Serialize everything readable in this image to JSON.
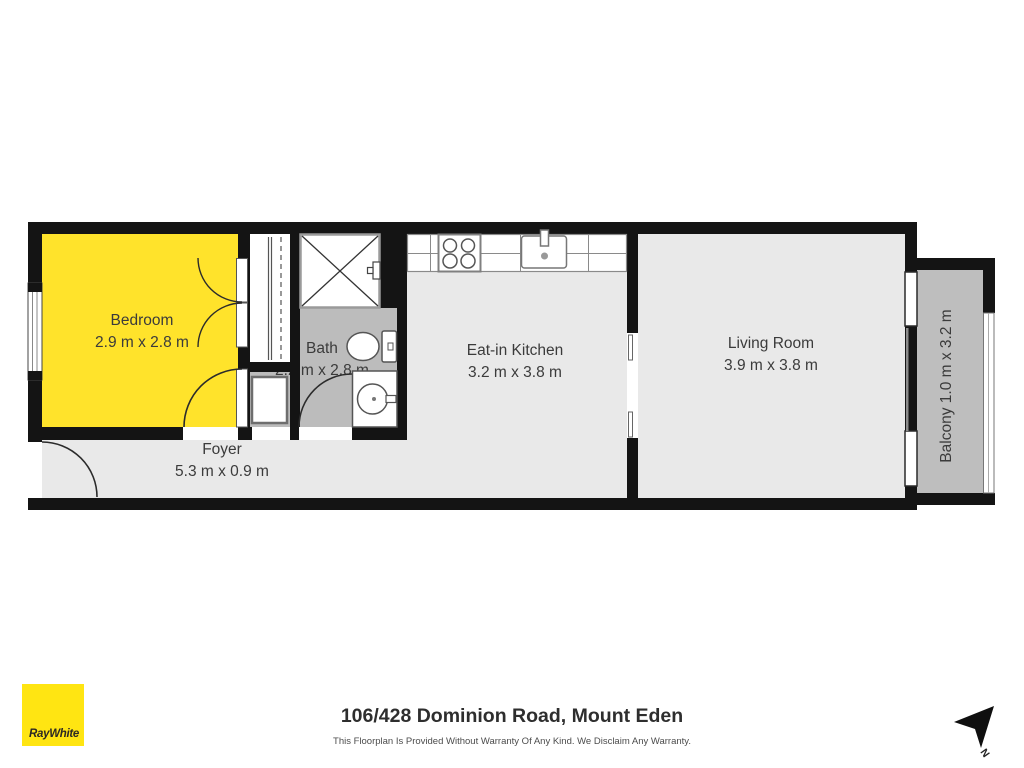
{
  "plan": {
    "rooms": [
      {
        "name": "Bedroom",
        "dims": "2.9 m x 2.8 m"
      },
      {
        "name": "Bath",
        "dims": "2.2 m x 2.8 m"
      },
      {
        "name": "Eat-in Kitchen",
        "dims": "3.2 m x 3.8 m"
      },
      {
        "name": "Living Room",
        "dims": "3.9 m x 3.8 m"
      },
      {
        "name": "Foyer",
        "dims": "5.3 m x 0.9 m"
      },
      {
        "name": "Balcony",
        "dims": "1.0 m x 3.2 m"
      }
    ],
    "colors": {
      "bedroom": "#FFE32B",
      "floor": "#E9E9E9",
      "wet": "#BCBCBC",
      "balcony": "#BEBEBE",
      "wall": "#141414",
      "logo": "#FFE512"
    },
    "icons": {
      "shower": "crossed-square",
      "toilet": "cistern-and-bowl",
      "basin": "round-basin-vanity",
      "washer": "appliance-square",
      "stove": "four-burner-cooktop",
      "kitchen_sink": "sink-with-tap",
      "north_arrow": "compass-dart"
    }
  },
  "footer": {
    "logo_text": "RayWhite",
    "title": "106/428 Dominion Road, Mount Eden",
    "disclaimer": "This Floorplan Is Provided Without Warranty Of Any Kind. We Disclaim Any Warranty.",
    "north_label": "N"
  }
}
